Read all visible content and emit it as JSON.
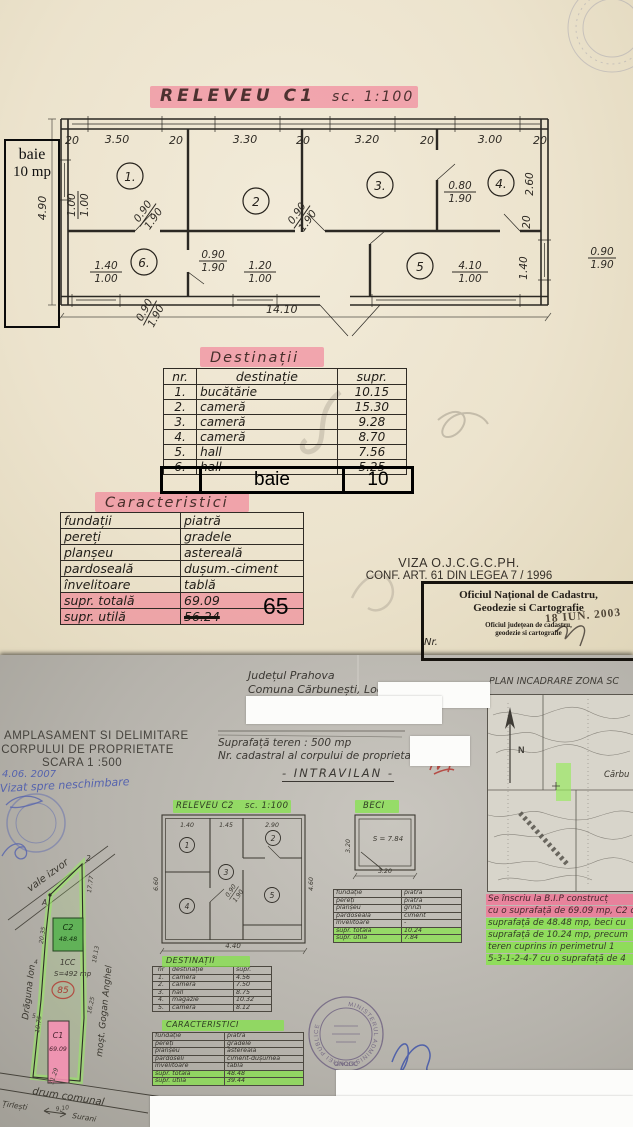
{
  "colors": {
    "pink_highlight": "#f36e8c",
    "green_highlight": "#82e446",
    "paper_top": "#ece3cd",
    "paper_bottom": "#b6b3ac",
    "pink_parcel": "#f590b4",
    "green_parcel": "#53b04b",
    "blue_ink": "#5563ae",
    "red_ink": "#b4403a"
  },
  "page1": {
    "title": "RELEVEU C1",
    "title_scale": "sc. 1:100",
    "baie_box": {
      "line1": "baie",
      "line2": "10 mp"
    },
    "plan": {
      "dims_top": [
        "20",
        "3.50",
        "20",
        "3.30",
        "20",
        "3.20",
        "20",
        "3.00",
        "20"
      ],
      "dim_left": "4.90",
      "dim_bottom": "14.10",
      "dims_right": [
        "2.60",
        "20",
        "1.40"
      ],
      "rooms": [
        "1.",
        "2",
        "3.",
        "4.",
        "5",
        "6."
      ],
      "fracs": [
        {
          "a": "1.00",
          "b": "1.00"
        },
        {
          "a": "0.90",
          "b": "1.90"
        },
        {
          "a": "0.90",
          "b": "1.90"
        },
        {
          "a": "0.80",
          "b": "1.90"
        },
        {
          "a": "0.90",
          "b": "1.90"
        },
        {
          "a": "1.40",
          "b": "1.00"
        },
        {
          "a": "1.20",
          "b": "1.00"
        },
        {
          "a": "0.90",
          "b": "1.90"
        },
        {
          "a": "4.10",
          "b": "1.00"
        },
        {
          "a": "0.90",
          "b": "1.90"
        }
      ]
    },
    "destinatii": {
      "title": "Destinații",
      "headers": [
        "nr.",
        "destinație",
        "supr."
      ],
      "rows": [
        [
          "1.",
          "bucătărie",
          "10.15"
        ],
        [
          "2.",
          "cameră",
          "15.30"
        ],
        [
          "3.",
          "cameră",
          "9.28"
        ],
        [
          "4.",
          "cameră",
          "8.70"
        ],
        [
          "5.",
          "hall",
          "7.56"
        ],
        [
          "6.",
          "hall",
          "5.25"
        ]
      ],
      "added_row": {
        "dest": "baie",
        "supr": "10"
      }
    },
    "caracteristici": {
      "title": "Caracteristici",
      "rows": [
        [
          "fundații",
          "piatră"
        ],
        [
          "pereți",
          "gradele"
        ],
        [
          "planșeu",
          "astereală"
        ],
        [
          "pardoseală",
          "dușum.-ciment"
        ],
        [
          "învelitoare",
          "tablă"
        ],
        [
          "supr. totală",
          "69.09"
        ],
        [
          "supr. utilă",
          "56.24"
        ]
      ],
      "correction": "65"
    },
    "viza_line1": "VIZA O.J.C.G.C.PH.",
    "viza_line2": "CONF. ART. 61 DIN LEGEA 7 / 1996",
    "stamp_box": {
      "l1": "Oficiul Național de Cadastru,",
      "l2": "Geodezie si Cartografie",
      "l3": "Oficiul județean de cadastru,",
      "l4": "geodezie si cartografie",
      "date": "18 IUN. 2003",
      "nr": "Nr."
    }
  },
  "page2": {
    "header": [
      "AN AMPLASAMENT SI DELIMITARE",
      "A CORPULUI DE PROPRIETATE",
      "SCARA 1 :500"
    ],
    "hand_blue": {
      "date": "4.06. 2007",
      "vizat": "Vizat spre neschimbare"
    },
    "info": {
      "l1": "Județul Prahova",
      "l2": "Comuna Cărbunești, Loc. Cărbunești",
      "l3": "Suprafață teren : 500 mp",
      "l4": "Nr. cadastral al corpului de proprietate :",
      "l5": "- INTRAVILAN -"
    },
    "map": {
      "title": "PLAN INCADRARE ZONĂ SC",
      "town": "Cărbu",
      "n": "N"
    },
    "site": {
      "vale": "vale izvor",
      "owner_left": "Drăguna Ion",
      "owner_right": "moșt. Gogan Anghel",
      "cc": "1CC",
      "area": "S=492 mp",
      "lot": "85",
      "c2": "C2",
      "c2_area": "48.48",
      "c1": "C1",
      "c1_area": "69.09",
      "road": "drum comunal",
      "dir1": "Țirlești",
      "dir2": "Surani",
      "pt_a": "A",
      "pt_2": "2",
      "pt_4": "4",
      "pt_5": "5",
      "d1": "20.35",
      "d2": "17.77",
      "d3": "18.13",
      "d4": "16.25",
      "d5": "10.75",
      "d6": "11.29",
      "d7": "9.10"
    },
    "releveu2": {
      "title": "RELEVEU C2",
      "scale": "sc. 1:100",
      "rooms": [
        "1",
        "2",
        "3",
        "4",
        "5"
      ],
      "dims_top": [
        "1.40",
        "1.45",
        "2.90"
      ],
      "dim_bottom": "4.40",
      "dim_right": "4.60",
      "dim_left": "6.60",
      "frac": {
        "a": "0.90",
        "b": "1.90"
      }
    },
    "beci": {
      "title": "BECI",
      "area": "S = 7.84",
      "dim_bottom": "3.20",
      "dim_left": "3.20",
      "table": [
        [
          "fundație",
          "piatră"
        ],
        [
          "pereți",
          "piatră"
        ],
        [
          "planșeu",
          "grinzi"
        ],
        [
          "pardoseală",
          "ciment"
        ],
        [
          "învelitoare",
          "-"
        ],
        [
          "supr. totală",
          "10.24"
        ],
        [
          "supr. utilă",
          "7.84"
        ]
      ]
    },
    "destinatii": {
      "title": "DESTINAȚII",
      "headers": [
        "nr",
        "destinație",
        "supr."
      ],
      "rows": [
        [
          "1.",
          "cameră",
          "4.56"
        ],
        [
          "2.",
          "cameră",
          "7.50"
        ],
        [
          "3.",
          "hall",
          "8.75"
        ],
        [
          "4.",
          "magazie",
          "10.32"
        ],
        [
          "5.",
          "cameră",
          "8.12"
        ]
      ]
    },
    "caracteristici": {
      "title": "CARACTERISTICI",
      "rows": [
        [
          "fundație",
          "piatră"
        ],
        [
          "pereți",
          "gradele"
        ],
        [
          "planșeu",
          "astereală"
        ],
        [
          "pardoseli",
          "ciment-dușumea"
        ],
        [
          "învelitoare",
          "tablă"
        ],
        [
          "supr. totală",
          "48.48"
        ],
        [
          "supr. utilă",
          "39.44"
        ]
      ]
    },
    "stamp": {
      "ring": "MINISTERUL ADMINISTRAȚIEI PUBLICE",
      "bottom": "ONCGC"
    },
    "note": {
      "lines": [
        {
          "text": "Se înscriu la B.I.P construcț",
          "hl": "pink"
        },
        {
          "text": "cu o suprafață de 69.09 mp, C2 c",
          "hl": "pink"
        },
        {
          "text": "suprafață de 48.48 mp, beci cu",
          "hl": "green"
        },
        {
          "text": "suprafață de 10.24 mp, precum",
          "hl": "green"
        },
        {
          "text": "teren cuprins in perimetrul 1",
          "hl": "green"
        },
        {
          "text": "5-3-1-2-4-7 cu o suprafață de 4",
          "hl": "green"
        }
      ]
    }
  }
}
